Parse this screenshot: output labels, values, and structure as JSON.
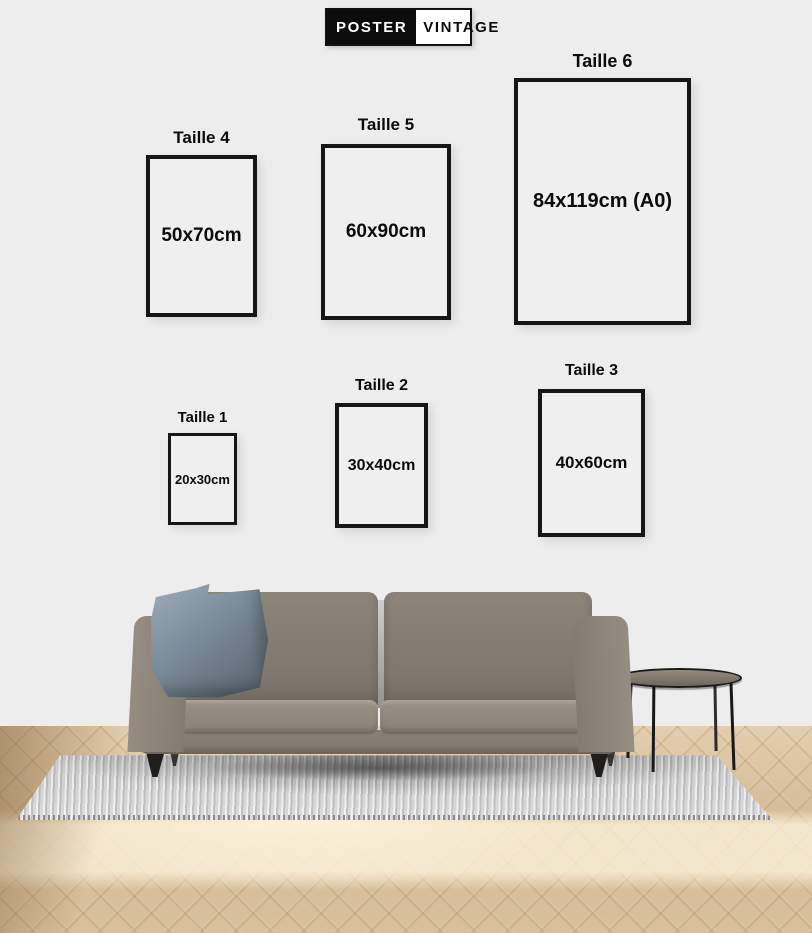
{
  "brand": {
    "name_left": "POSTER",
    "name_right": "VINTAGE"
  },
  "size_guide": {
    "frames": [
      {
        "label": "Taille 4",
        "dimensions": "50x70cm"
      },
      {
        "label": "Taille 5",
        "dimensions": "60x90cm"
      },
      {
        "label": "Taille 6",
        "dimensions": "84x119cm (A0)"
      },
      {
        "label": "Taille 1",
        "dimensions": "20x30cm"
      },
      {
        "label": "Taille 2",
        "dimensions": "30x40cm"
      },
      {
        "label": "Taille 3",
        "dimensions": "40x60cm"
      }
    ]
  },
  "colors": {
    "wall": "#ededed",
    "frame_border": "#161616",
    "text": "#0b0b0b",
    "sofa": "#857d72",
    "pillow": "#7b8a98",
    "rug": "#d4d4d4",
    "floor": "#d8bf9c",
    "legs": "#201e1c"
  }
}
